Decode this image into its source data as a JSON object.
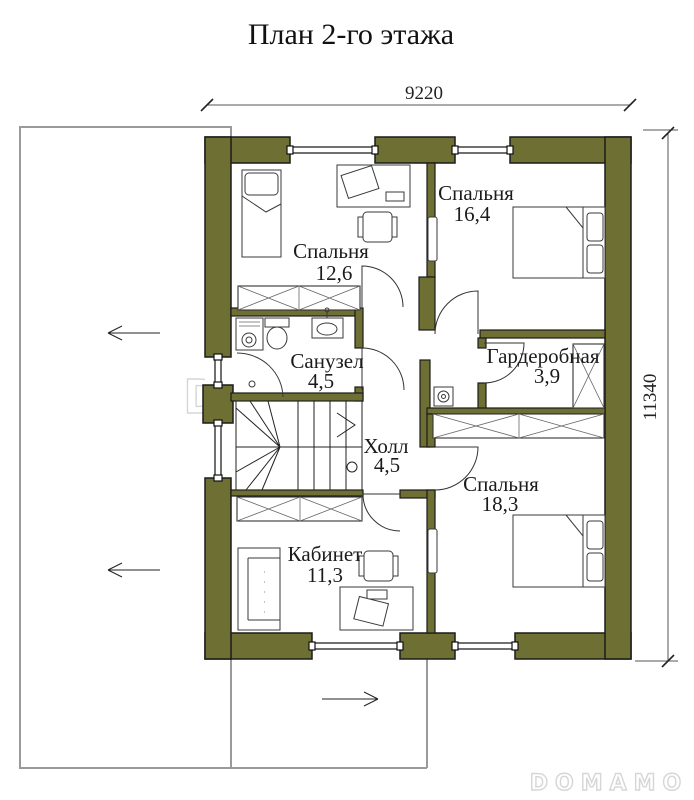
{
  "title": "План 2-го этажа",
  "dimensions": {
    "width": "9220",
    "height": "11340"
  },
  "rooms": {
    "bedroom1": {
      "name": "Спальня",
      "area": "12,6"
    },
    "bedroom2": {
      "name": "Спальня",
      "area": "16,4"
    },
    "bathroom": {
      "name": "Санузел",
      "area": "4,5"
    },
    "wardrobe": {
      "name": "Гардеробная",
      "area": "3,9"
    },
    "hall": {
      "name": "Холл",
      "area": "4,5"
    },
    "bedroom3": {
      "name": "Спальня",
      "area": "18,3"
    },
    "office": {
      "name": "Кабинет",
      "area": "11,3"
    }
  },
  "watermark": {
    "center": "DOMAMO",
    "corner": "DOMAMO"
  },
  "colors": {
    "wall": "#6e7033",
    "outline": "#1b1b1b",
    "terrace_line": "#9a9a9a",
    "watermark": "#d6d6d6"
  }
}
